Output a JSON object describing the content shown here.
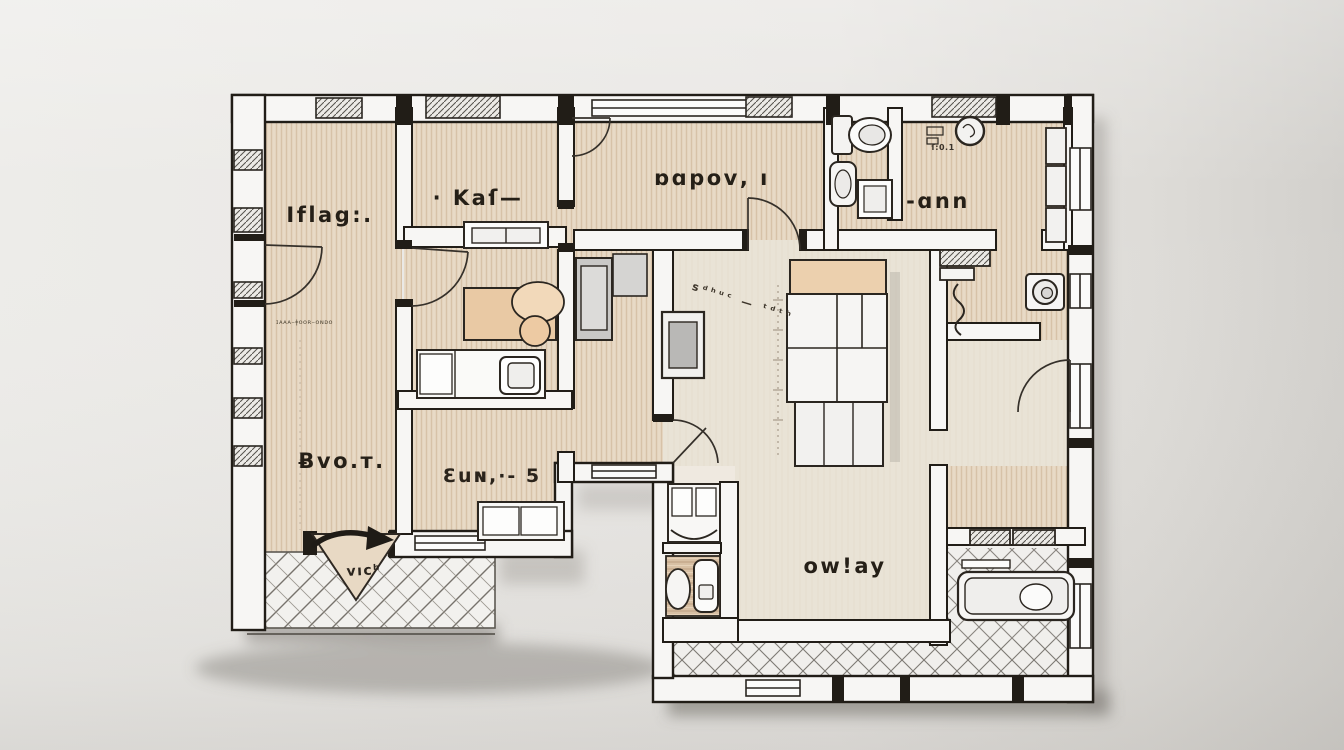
{
  "plan": {
    "title": "apartment-floor-plan-sketch",
    "rooms": [
      {
        "id": "room-top-left",
        "label": "Iflag:."
      },
      {
        "id": "room-kax",
        "label": "· Kaſ—"
      },
      {
        "id": "room-oupov",
        "label": "ɒɑpoᴠ, ı"
      },
      {
        "id": "room-ann",
        "label": "-ɑnn"
      },
      {
        "id": "room-bottom-left",
        "label": "Ƀvo.ᴛ."
      },
      {
        "id": "room-eun",
        "label": "Ɛuɴ,·- 5"
      },
      {
        "id": "room-owlay",
        "label": "ow!ay"
      }
    ],
    "annotations": {
      "entry_label": "ᴠıcʰ",
      "scale_note": "ſ:0.1",
      "dim_note": "ɪᴀᴀᴀ–ǂᴏᴏʀ–ᴏɴᴅᴏ",
      "sketch_note": "ꜱᵈʰᵘᶜ — ᵗᵈᵗʰ"
    },
    "palette": {
      "background": "#e9e7e4",
      "floor_beige": "#e4d4bf",
      "floor_cream": "#e9e3d7",
      "wall_fill": "#f7f6f4",
      "line": "#211d17",
      "accent_tan": "#ecd0ae",
      "wood_cabinet": "#d9c2a6",
      "shadow": "#6f6b65"
    }
  }
}
